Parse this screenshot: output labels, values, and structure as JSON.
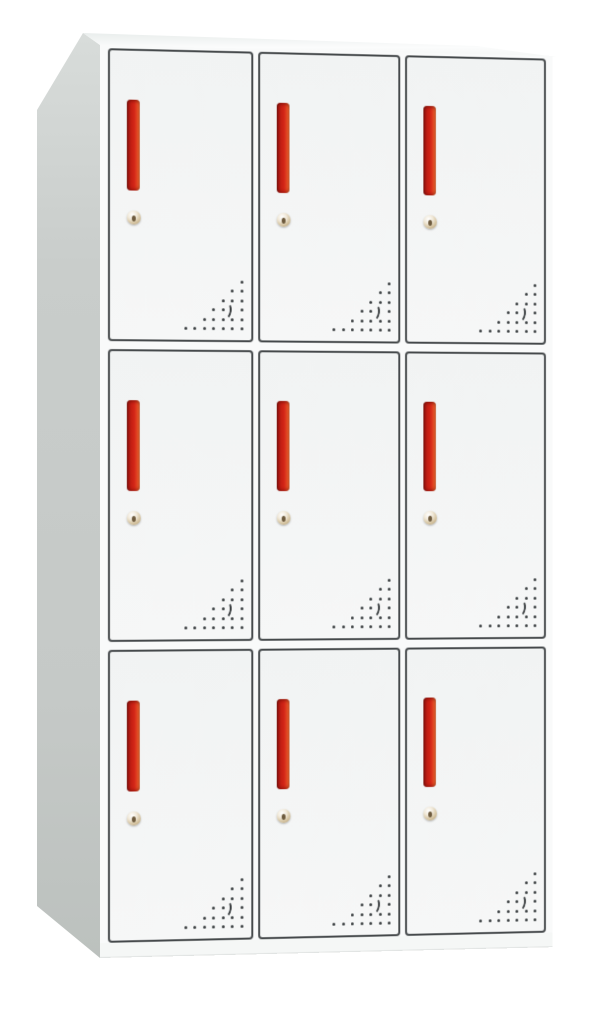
{
  "scene": {
    "type": "product-photo",
    "subject": "9-compartment steel locker cabinet",
    "view": "front three-quarter from the left",
    "background_color": "#ffffff"
  },
  "cabinet": {
    "rows": 3,
    "columns": 3,
    "door_count": 9,
    "colors": {
      "frame": "#f9fafa",
      "door_top": "#f1f3f3",
      "door_bottom": "#f6f7f7",
      "door_border": "#45494b",
      "side_top": "#d8dcda",
      "side_bottom": "#bcc1be",
      "top_surface": "#fbfcfc",
      "plinth": "#f5f7f6"
    }
  },
  "door_features": {
    "handle": {
      "shape": "vertical recessed pull bar",
      "color_dark": "#7f130c",
      "color_main": "#d22517",
      "color_highlight": "#ef7c3e"
    },
    "lock": {
      "shape": "round cam lock",
      "color": "#d9c9a8",
      "keyhole_color": "#6d5a3d"
    },
    "vents": {
      "shape": "triangular perforation grid, bottom-right corner",
      "dot_color": "#3a3e40",
      "dot_size": 3,
      "col_spacing": 9.5,
      "row_spacing": 9.4,
      "rows": [
        [
          0
        ],
        [
          0,
          1
        ],
        [
          0,
          1,
          2
        ],
        [
          0,
          2,
          3
        ],
        [
          0,
          1,
          2,
          3,
          4
        ],
        [
          0,
          1,
          2,
          3,
          4,
          5,
          6
        ]
      ],
      "crescent": {
        "row": 3,
        "col": 1
      }
    }
  }
}
